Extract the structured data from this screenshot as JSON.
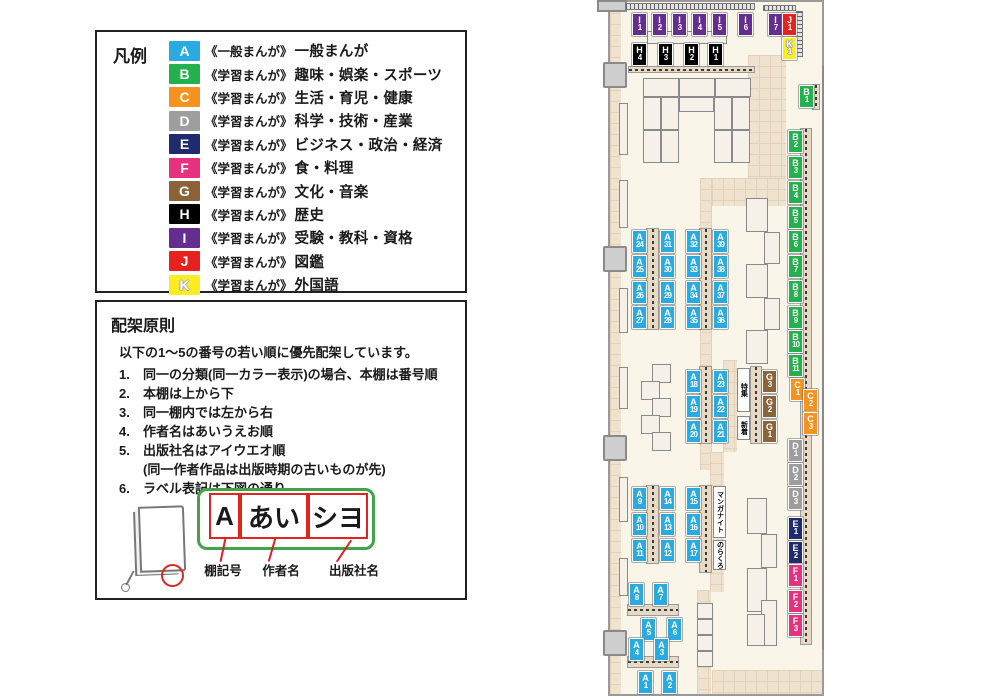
{
  "legend": {
    "title": "凡例",
    "items": [
      {
        "code": "A",
        "color": "#29ABE2",
        "series": "《一般まんが》",
        "label": "一般まんが"
      },
      {
        "code": "B",
        "color": "#22B14C",
        "series": "《学習まんが》",
        "label": "趣味・娯楽・スポーツ"
      },
      {
        "code": "C",
        "color": "#F6921E",
        "series": "《学習まんが》",
        "label": "生活・育児・健康"
      },
      {
        "code": "D",
        "color": "#9E9E9E",
        "series": "《学習まんが》",
        "label": "科学・技術・産業"
      },
      {
        "code": "E",
        "color": "#1F2B6E",
        "series": "《学習まんが》",
        "label": "ビジネス・政治・経済"
      },
      {
        "code": "F",
        "color": "#E8317E",
        "series": "《学習まんが》",
        "label": "食・料理"
      },
      {
        "code": "G",
        "color": "#8C6239",
        "series": "《学習まんが》",
        "label": "文化・音楽"
      },
      {
        "code": "H",
        "color": "#000000",
        "series": "《学習まんが》",
        "label": "歴史"
      },
      {
        "code": "I",
        "color": "#662D91",
        "series": "《学習まんが》",
        "label": "受験・教科・資格"
      },
      {
        "code": "J",
        "color": "#E8211F",
        "series": "《学習まんが》",
        "label": "図鑑"
      },
      {
        "code": "K",
        "color": "#FBED21",
        "series": "《学習まんが》",
        "label": "外国語",
        "outlined": true
      }
    ]
  },
  "principles": {
    "title": "配架原則",
    "intro": "以下の1〜5の番号の若い順に優先配架しています。",
    "rules": [
      {
        "num": "1.",
        "text": "同一の分類(同一カラー表示)の場合、本棚は番号順"
      },
      {
        "num": "2.",
        "text": "本棚は上から下"
      },
      {
        "num": "3.",
        "text": "同一棚内では左から右"
      },
      {
        "num": "4.",
        "text": "作者名はあいうえお順"
      },
      {
        "num": "5.",
        "text": "出版社名はアイウエオ順",
        "note": "(同一作者作品は出版時期の古いものが先)"
      },
      {
        "num": "6.",
        "text": "ラベル表記は下図の通り"
      }
    ],
    "label_diagram": {
      "segments": [
        {
          "text": "A",
          "caption": "棚記号"
        },
        {
          "text": "あい",
          "caption": "作者名"
        },
        {
          "text": "シヨ",
          "caption": "出版社名"
        }
      ]
    }
  },
  "map": {
    "colors": {
      "A": "#29ABE2",
      "B": "#22B14C",
      "C": "#F6921E",
      "D": "#9E9E9E",
      "E": "#1F2B6E",
      "F": "#E8317E",
      "G": "#8C6239",
      "H": "#000000",
      "I": "#662D91",
      "J": "#E8211F",
      "K": "#FBED21"
    },
    "labels": [
      {
        "t": "I",
        "n": "1",
        "x": 37,
        "y": 13
      },
      {
        "t": "I",
        "n": "2",
        "x": 57,
        "y": 13
      },
      {
        "t": "I",
        "n": "3",
        "x": 77,
        "y": 13
      },
      {
        "t": "I",
        "n": "4",
        "x": 97,
        "y": 13
      },
      {
        "t": "I",
        "n": "5",
        "x": 117,
        "y": 13
      },
      {
        "t": "I",
        "n": "6",
        "x": 143,
        "y": 13
      },
      {
        "t": "I",
        "n": "7",
        "x": 173,
        "y": 13
      },
      {
        "t": "J",
        "n": "1",
        "x": 187,
        "y": 13
      },
      {
        "t": "K",
        "n": "1",
        "x": 187,
        "y": 37
      },
      {
        "t": "H",
        "n": "4",
        "x": 37,
        "y": 43
      },
      {
        "t": "H",
        "n": "3",
        "x": 63,
        "y": 43
      },
      {
        "t": "H",
        "n": "2",
        "x": 89,
        "y": 43
      },
      {
        "t": "H",
        "n": "1",
        "x": 113,
        "y": 43
      },
      {
        "t": "B",
        "n": "1",
        "x": 204,
        "y": 85
      },
      {
        "t": "B",
        "n": "2",
        "x": 193,
        "y": 130
      },
      {
        "t": "B",
        "n": "3",
        "x": 193,
        "y": 156
      },
      {
        "t": "B",
        "n": "4",
        "x": 193,
        "y": 181
      },
      {
        "t": "B",
        "n": "5",
        "x": 193,
        "y": 206
      },
      {
        "t": "B",
        "n": "6",
        "x": 193,
        "y": 230
      },
      {
        "t": "B",
        "n": "7",
        "x": 193,
        "y": 255
      },
      {
        "t": "B",
        "n": "8",
        "x": 193,
        "y": 280
      },
      {
        "t": "B",
        "n": "9",
        "x": 193,
        "y": 306
      },
      {
        "t": "B",
        "n": "10",
        "x": 193,
        "y": 330
      },
      {
        "t": "B",
        "n": "11",
        "x": 193,
        "y": 354
      },
      {
        "t": "C",
        "n": "1",
        "x": 195,
        "y": 378
      },
      {
        "t": "C",
        "n": "2",
        "x": 208,
        "y": 389
      },
      {
        "t": "C",
        "n": "3",
        "x": 208,
        "y": 412
      },
      {
        "t": "D",
        "n": "1",
        "x": 193,
        "y": 439
      },
      {
        "t": "D",
        "n": "2",
        "x": 193,
        "y": 463
      },
      {
        "t": "D",
        "n": "3",
        "x": 193,
        "y": 487
      },
      {
        "t": "E",
        "n": "1",
        "x": 193,
        "y": 517
      },
      {
        "t": "E",
        "n": "2",
        "x": 193,
        "y": 541
      },
      {
        "t": "F",
        "n": "1",
        "x": 193,
        "y": 564
      },
      {
        "t": "F",
        "n": "2",
        "x": 193,
        "y": 590
      },
      {
        "t": "F",
        "n": "3",
        "x": 193,
        "y": 614
      },
      {
        "t": "A",
        "n": "24",
        "x": 37,
        "y": 230
      },
      {
        "t": "A",
        "n": "31",
        "x": 65,
        "y": 230
      },
      {
        "t": "A",
        "n": "25",
        "x": 37,
        "y": 255
      },
      {
        "t": "A",
        "n": "30",
        "x": 65,
        "y": 255
      },
      {
        "t": "A",
        "n": "26",
        "x": 37,
        "y": 281
      },
      {
        "t": "A",
        "n": "29",
        "x": 65,
        "y": 281
      },
      {
        "t": "A",
        "n": "27",
        "x": 37,
        "y": 306
      },
      {
        "t": "A",
        "n": "28",
        "x": 65,
        "y": 306
      },
      {
        "t": "A",
        "n": "32",
        "x": 91,
        "y": 230
      },
      {
        "t": "A",
        "n": "39",
        "x": 118,
        "y": 230
      },
      {
        "t": "A",
        "n": "33",
        "x": 91,
        "y": 255
      },
      {
        "t": "A",
        "n": "38",
        "x": 118,
        "y": 255
      },
      {
        "t": "A",
        "n": "34",
        "x": 91,
        "y": 281
      },
      {
        "t": "A",
        "n": "37",
        "x": 118,
        "y": 281
      },
      {
        "t": "A",
        "n": "35",
        "x": 91,
        "y": 306
      },
      {
        "t": "A",
        "n": "36",
        "x": 118,
        "y": 306
      },
      {
        "t": "A",
        "n": "18",
        "x": 91,
        "y": 370
      },
      {
        "t": "A",
        "n": "23",
        "x": 118,
        "y": 370
      },
      {
        "t": "A",
        "n": "19",
        "x": 91,
        "y": 395
      },
      {
        "t": "A",
        "n": "22",
        "x": 118,
        "y": 395
      },
      {
        "t": "A",
        "n": "20",
        "x": 91,
        "y": 420
      },
      {
        "t": "A",
        "n": "21",
        "x": 118,
        "y": 420
      },
      {
        "t": "G",
        "n": "3",
        "x": 167,
        "y": 370
      },
      {
        "t": "G",
        "n": "2",
        "x": 167,
        "y": 395
      },
      {
        "t": "G",
        "n": "1",
        "x": 167,
        "y": 420
      },
      {
        "t": "A",
        "n": "9",
        "x": 37,
        "y": 487
      },
      {
        "t": "A",
        "n": "14",
        "x": 65,
        "y": 487
      },
      {
        "t": "A",
        "n": "10",
        "x": 37,
        "y": 513
      },
      {
        "t": "A",
        "n": "13",
        "x": 65,
        "y": 513
      },
      {
        "t": "A",
        "n": "11",
        "x": 37,
        "y": 539
      },
      {
        "t": "A",
        "n": "12",
        "x": 65,
        "y": 539
      },
      {
        "t": "A",
        "n": "15",
        "x": 91,
        "y": 487
      },
      {
        "t": "A",
        "n": "16",
        "x": 91,
        "y": 513
      },
      {
        "t": "A",
        "n": "17",
        "x": 91,
        "y": 539
      },
      {
        "t": "A",
        "n": "8",
        "x": 34,
        "y": 583
      },
      {
        "t": "A",
        "n": "7",
        "x": 58,
        "y": 583
      },
      {
        "t": "A",
        "n": "5",
        "x": 46,
        "y": 618
      },
      {
        "t": "A",
        "n": "6",
        "x": 72,
        "y": 618
      },
      {
        "t": "A",
        "n": "4",
        "x": 34,
        "y": 638
      },
      {
        "t": "A",
        "n": "3",
        "x": 59,
        "y": 638
      },
      {
        "t": "A",
        "n": "1",
        "x": 43,
        "y": 671
      },
      {
        "t": "A",
        "n": "2",
        "x": 67,
        "y": 671
      }
    ],
    "special_labels": [
      {
        "text": "特集",
        "x": 142,
        "y": 368,
        "h": 44
      },
      {
        "text": "新着",
        "x": 142,
        "y": 416,
        "h": 24
      },
      {
        "text": "マンガナイト",
        "x": 118,
        "y": 486,
        "h": 52
      },
      {
        "text": "のらくろ",
        "x": 118,
        "y": 540,
        "h": 30
      }
    ]
  }
}
